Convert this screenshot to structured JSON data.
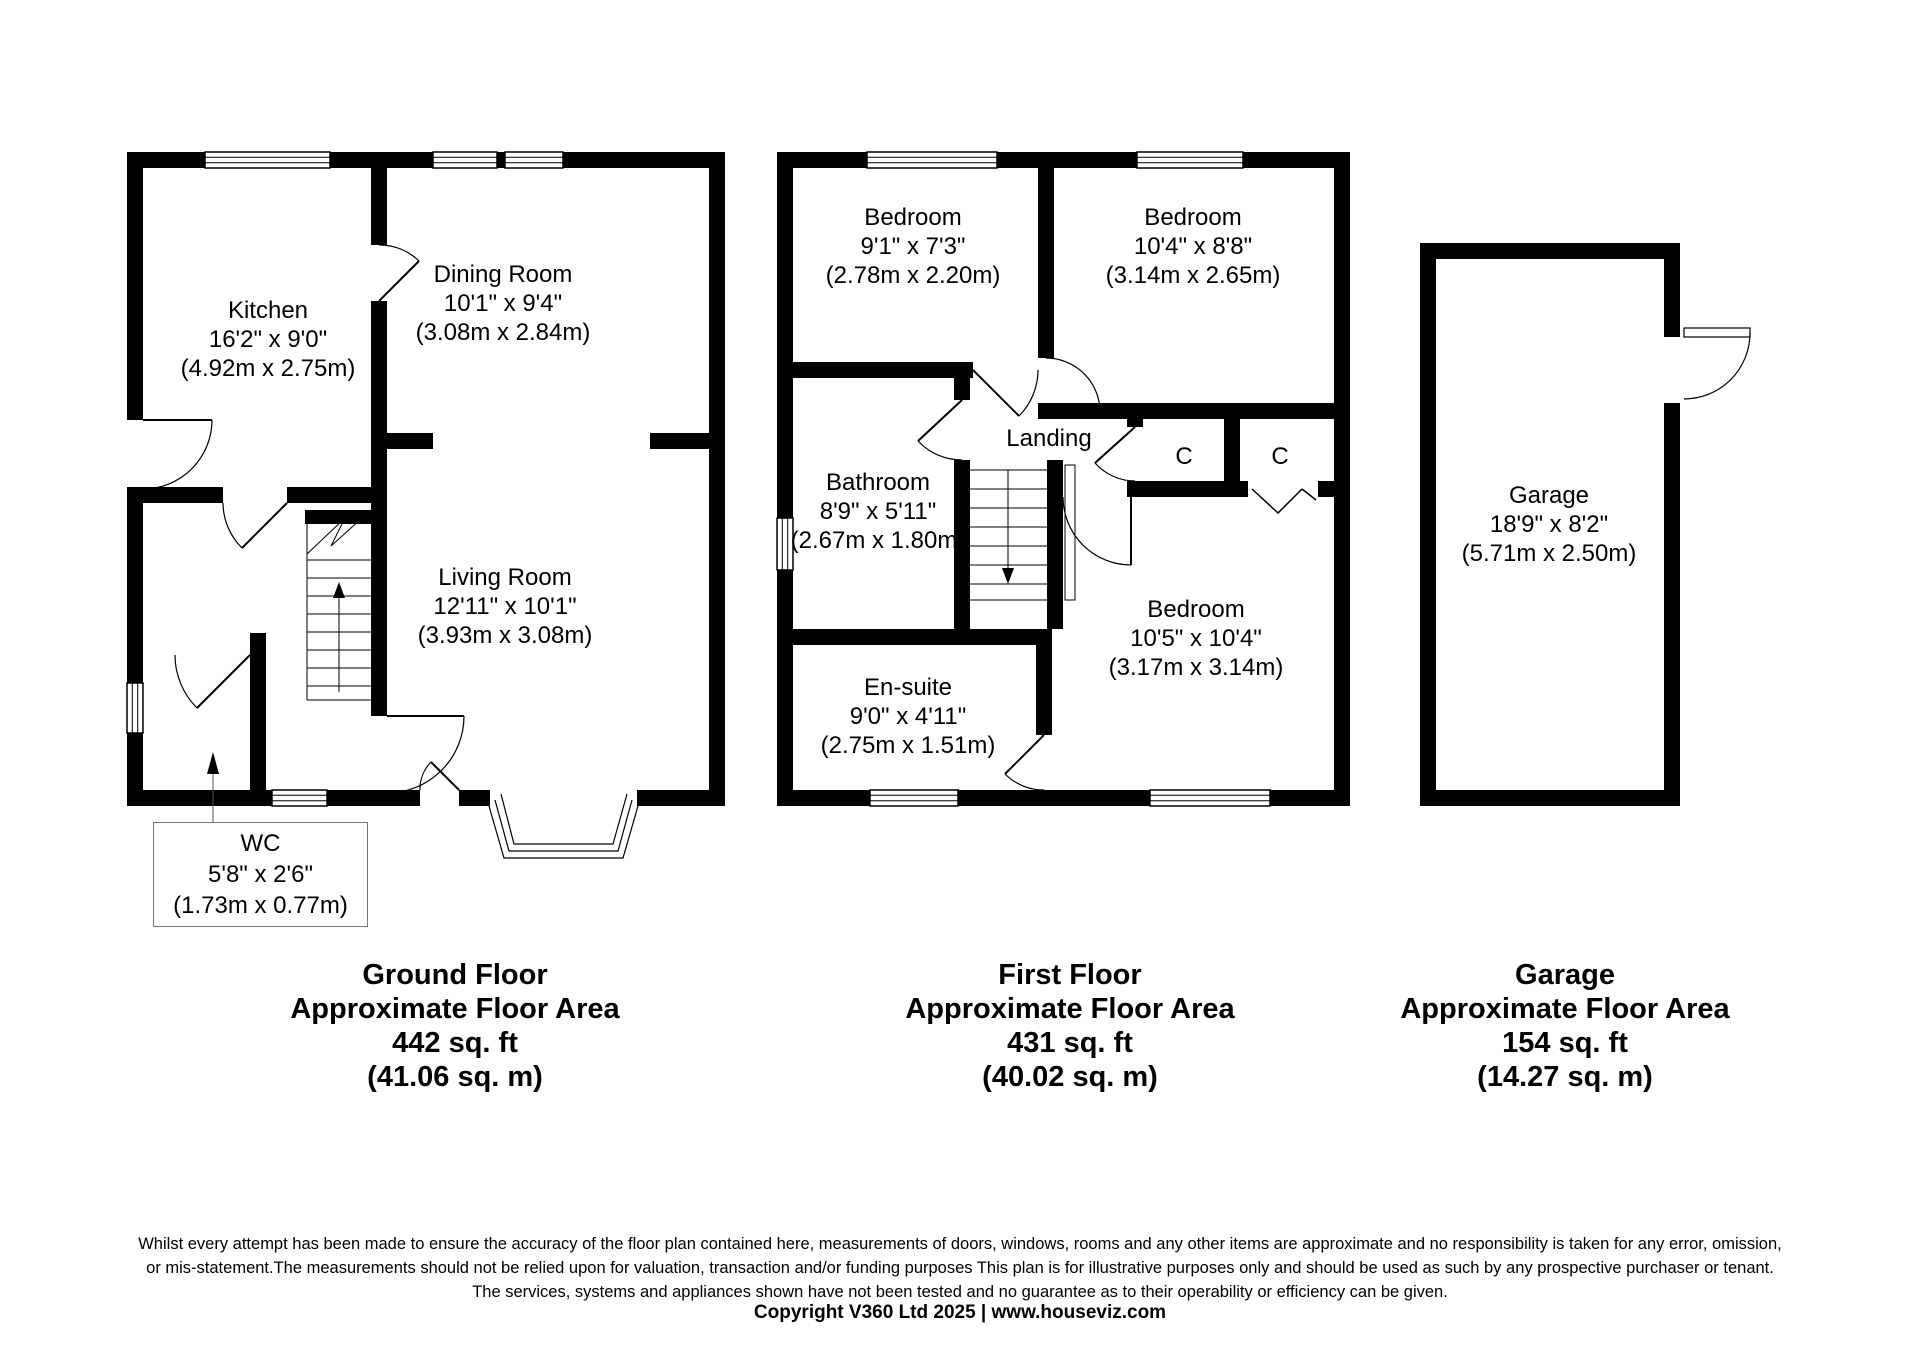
{
  "plans": {
    "ground": {
      "rooms": {
        "kitchen": {
          "name": "Kitchen",
          "imperial": "16'2\" x 9'0\"",
          "metric": "(4.92m x 2.75m)"
        },
        "dining": {
          "name": "Dining Room",
          "imperial": "10'1\" x 9'4\"",
          "metric": "(3.08m x 2.84m)"
        },
        "living": {
          "name": "Living Room",
          "imperial": "12'11\" x 10'1\"",
          "metric": "(3.93m x 3.08m)"
        },
        "wc": {
          "name": "WC",
          "imperial": "5'8\" x 2'6\"",
          "metric": "(1.73m x 0.77m)"
        }
      },
      "summary": {
        "title": "Ground Floor",
        "subtitle": "Approximate Floor Area",
        "area_ft": "442 sq. ft",
        "area_m": "(41.06 sq. m)"
      }
    },
    "first": {
      "rooms": {
        "bedroom1": {
          "name": "Bedroom",
          "imperial": "9'1\" x 7'3\"",
          "metric": "(2.78m x 2.20m)"
        },
        "bedroom2": {
          "name": "Bedroom",
          "imperial": "10'4\" x 8'8\"",
          "metric": "(3.14m x 2.65m)"
        },
        "bathroom": {
          "name": "Bathroom",
          "imperial": "8'9\" x 5'11\"",
          "metric": "(2.67m x 1.80m)"
        },
        "landing": {
          "name": "Landing"
        },
        "closet1": {
          "name": "C"
        },
        "closet2": {
          "name": "C"
        },
        "bedroom3": {
          "name": "Bedroom",
          "imperial": "10'5\" x 10'4\"",
          "metric": "(3.17m x 3.14m)"
        },
        "ensuite": {
          "name": "En-suite",
          "imperial": "9'0\" x 4'11\"",
          "metric": "(2.75m x 1.51m)"
        }
      },
      "summary": {
        "title": "First Floor",
        "subtitle": "Approximate Floor Area",
        "area_ft": "431 sq. ft",
        "area_m": "(40.02 sq. m)"
      }
    },
    "garage": {
      "rooms": {
        "garage": {
          "name": "Garage",
          "imperial": "18'9\" x 8'2\"",
          "metric": "(5.71m x 2.50m)"
        }
      },
      "summary": {
        "title": "Garage",
        "subtitle": "Approximate Floor Area",
        "area_ft": "154 sq. ft",
        "area_m": "(14.27 sq. m)"
      }
    }
  },
  "footer": {
    "disclaimer1": "Whilst every attempt has been made to ensure the accuracy of the floor plan contained here, measurements of doors, windows, rooms and any other items are approximate and no responsibility is taken for any error, omission,",
    "disclaimer2": "or mis-statement.The measurements should not be relied upon for valuation, transaction and/or funding purposes This plan is for illustrative purposes only and should be used as such by any prospective purchaser or tenant.",
    "disclaimer3": "The services, systems and appliances shown have not been tested and no guarantee as to their operability or efficiency can be given.",
    "copyright": "Copyright V360 Ltd 2025 | www.houseviz.com"
  }
}
